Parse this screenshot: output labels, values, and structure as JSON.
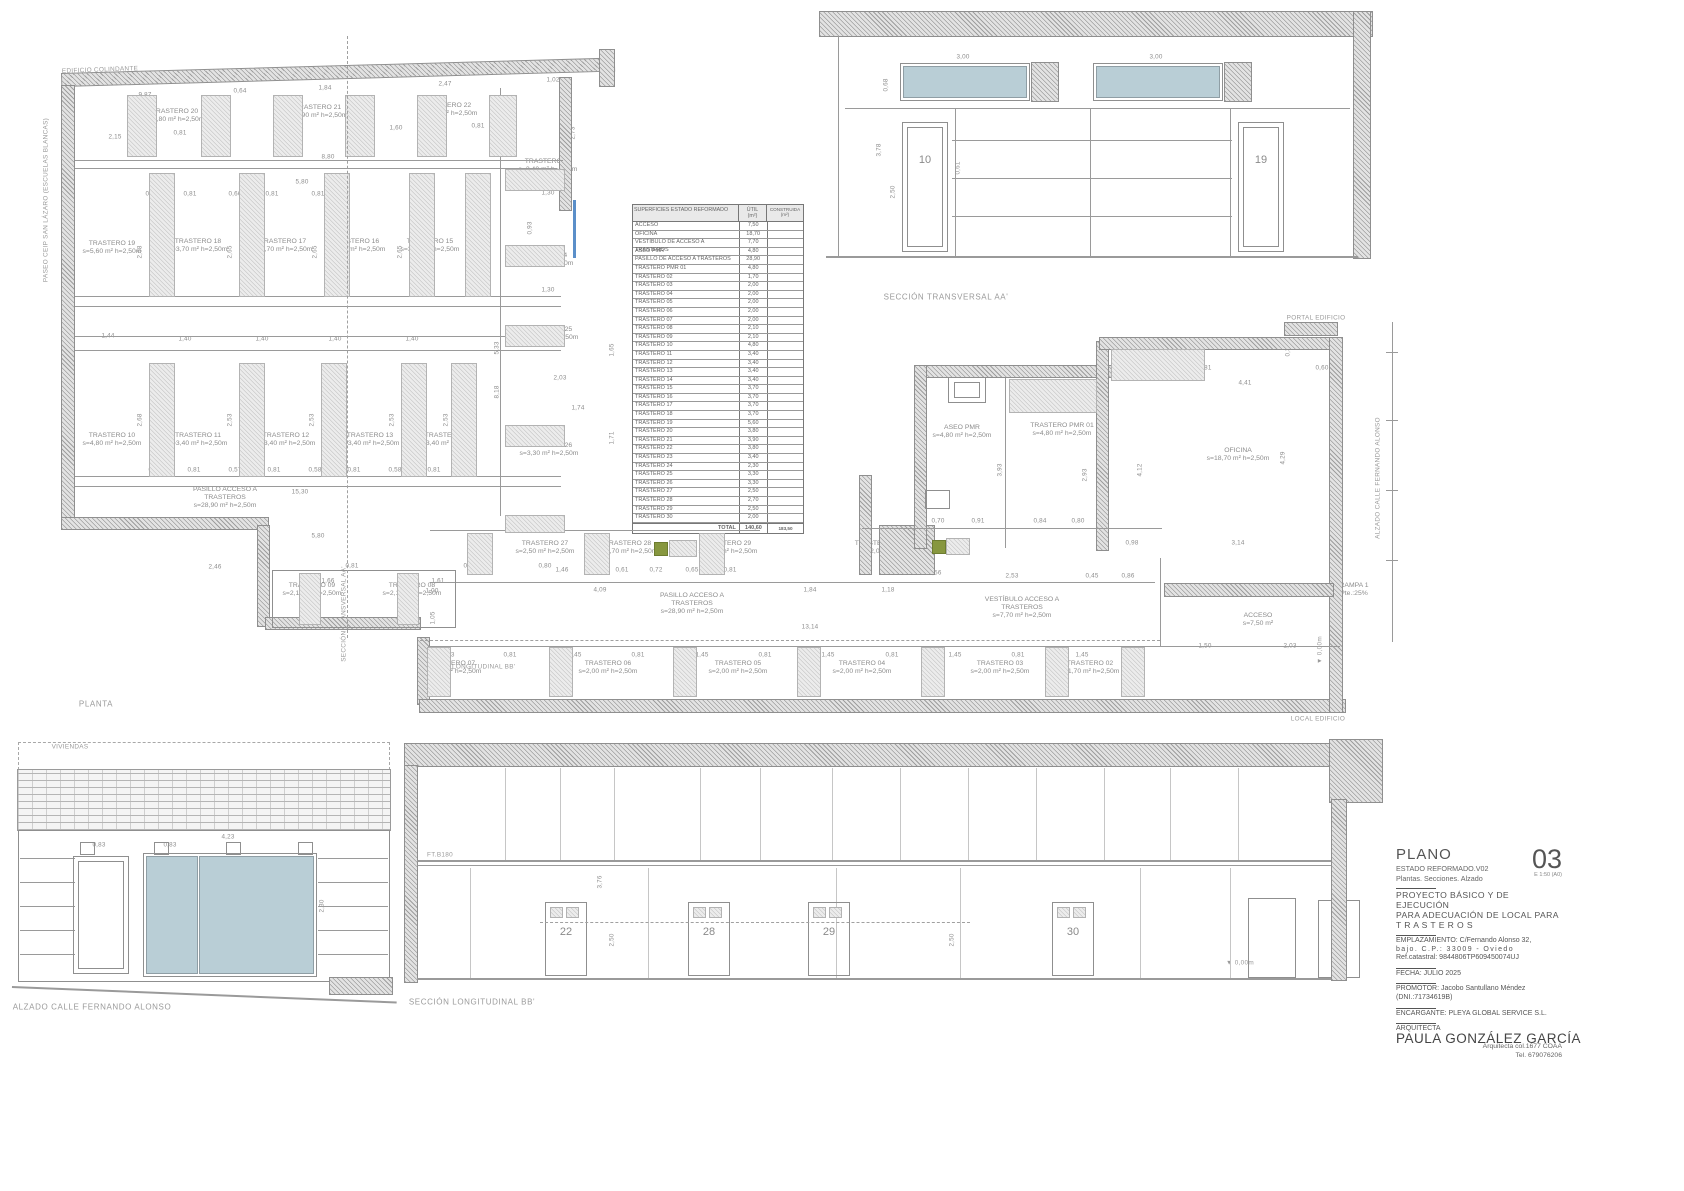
{
  "title_block": {
    "plano_label": "PLANO",
    "estado": "ESTADO REFORMADO.V02",
    "contenido": "Plantas. Secciones. Alzado",
    "sheet_number": "03",
    "scale": "E 1:50 (A0)",
    "proyecto_l1": "PROYECTO BÁSICO Y DE EJECUCIÓN",
    "proyecto_l2": "PARA ADECUACIÓN DE LOCAL PARA",
    "proyecto_l3": "T R A S T E R O S",
    "emplazamiento_l1": "EMPLAZAMIENTO: C/Fernando Alonso 32,",
    "emplazamiento_l2": "bajo. C.P.: 33009 - Oviedo",
    "emplazamiento_l3": "Ref.catastral: 9844806TP609450074UJ",
    "fecha": "FECHA: JULIO 2025",
    "promotor_l1": "PROMOTOR: Jacobo Santullano Méndez",
    "promotor_l2": "(DNI.:71734619B)",
    "encargante": "ENCARGANTE: PLEYA GLOBAL SERVICE S.L.",
    "arquitecta_label": "ARQUITECTA",
    "arquitecta_name": "PAULA GONZÁLEZ GARCÍA",
    "colegiada": "Arquitecta col.1677 COAA",
    "telefono": "Tel. 679076206"
  },
  "area_table": {
    "title": "SUPERFICIES ESTADO REFORMADO",
    "col_util": "ÚTIL",
    "col_construida": "CONSTRUIDA",
    "unit": "(m²)",
    "rows": [
      [
        "ACCESO",
        "7,50"
      ],
      [
        "OFICINA",
        "18,70"
      ],
      [
        "VESTÍBULO DE ACCESO A TRASTEROS",
        "7,70"
      ],
      [
        "ASEO PMR",
        "4,80"
      ],
      [
        "PASILLO DE ACCESO A TRASTEROS",
        "28,90"
      ],
      [
        "TRASTERO PMR 01",
        "4,80"
      ],
      [
        "TRASTERO 02",
        "1,70"
      ],
      [
        "TRASTERO 03",
        "2,00"
      ],
      [
        "TRASTERO 04",
        "2,00"
      ],
      [
        "TRASTERO 05",
        "2,00"
      ],
      [
        "TRASTERO 06",
        "2,00"
      ],
      [
        "TRASTERO 07",
        "2,00"
      ],
      [
        "TRASTERO 08",
        "2,10"
      ],
      [
        "TRASTERO 09",
        "2,10"
      ],
      [
        "TRASTERO 10",
        "4,80"
      ],
      [
        "TRASTERO 11",
        "3,40"
      ],
      [
        "TRASTERO 12",
        "3,40"
      ],
      [
        "TRASTERO 13",
        "3,40"
      ],
      [
        "TRASTERO 14",
        "3,40"
      ],
      [
        "TRASTERO 15",
        "3,70"
      ],
      [
        "TRASTERO 16",
        "3,70"
      ],
      [
        "TRASTERO 17",
        "3,70"
      ],
      [
        "TRASTERO 18",
        "3,70"
      ],
      [
        "TRASTERO 19",
        "5,60"
      ],
      [
        "TRASTERO 20",
        "3,80"
      ],
      [
        "TRASTERO 21",
        "3,90"
      ],
      [
        "TRASTERO 22",
        "3,80"
      ],
      [
        "TRASTERO 23",
        "3,40"
      ],
      [
        "TRASTERO 24",
        "2,30"
      ],
      [
        "TRASTERO 25",
        "3,30"
      ],
      [
        "TRASTERO 26",
        "3,30"
      ],
      [
        "TRASTERO 27",
        "2,50"
      ],
      [
        "TRASTERO 28",
        "2,70"
      ],
      [
        "TRASTERO 29",
        "2,50"
      ],
      [
        "TRASTERO 30",
        "2,00"
      ]
    ],
    "total_label": "TOTAL",
    "total_util": "140,60",
    "total_construida": "183,50"
  },
  "colors": {
    "glass": "#b9ced6",
    "wall_hatch": "#9e9e9e",
    "equipment_green": "#87973f",
    "section_marker_blue": "#5b8fc9"
  },
  "annotations": [
    {
      "t": "EDIFICIO COLINDANTE",
      "x": 100,
      "y": 70,
      "k": "tag",
      "r": -2
    },
    {
      "t": "PASEO CEIP SAN LÁZARO (ESCUELAS BLANCAS)",
      "x": 46,
      "y": 200,
      "k": "tag",
      "r": -90
    },
    {
      "t": "PLANTA",
      "x": 96,
      "y": 704,
      "k": "cap"
    },
    {
      "t": "SECCIÓN TRANSVERSAL AA'",
      "x": 946,
      "y": 297,
      "k": "cap"
    },
    {
      "t": "SECCIÓN LONGITUDINAL BB'",
      "x": 472,
      "y": 1002,
      "k": "cap"
    },
    {
      "t": "ALZADO CALLE FERNANDO ALONSO",
      "x": 92,
      "y": 1007,
      "k": "cap"
    },
    {
      "t": "VIVIENDAS",
      "x": 70,
      "y": 747,
      "k": "tag"
    },
    {
      "t": "FACHADA ANTERIOR",
      "x": 64,
      "y": 789,
      "k": "tag"
    },
    {
      "t": "PORTAL EDIFICIO",
      "x": 1316,
      "y": 318,
      "k": "tag"
    },
    {
      "t": "LOCAL EDIFICIO",
      "x": 1318,
      "y": 719,
      "k": "tag"
    },
    {
      "t": "ALZADO CALLE FERNANDO ALONSO",
      "x": 1378,
      "y": 478,
      "k": "tag",
      "r": -90
    },
    {
      "t": "SECCIÓN TRANSVERSAL AA'",
      "x": 344,
      "y": 614,
      "k": "tag",
      "r": -90
    },
    {
      "t": "SECCIÓN LONGITUDINAL BB'",
      "x": 467,
      "y": 667,
      "k": "tag"
    },
    {
      "t": "FT.B180",
      "x": 440,
      "y": 855,
      "k": "tag"
    },
    {
      "t": "▼ 0,00m",
      "x": 1240,
      "y": 963,
      "k": "tag"
    },
    {
      "t": "▼ 3,80m",
      "x": 310,
      "y": 786,
      "k": "tag"
    },
    {
      "t": "▼ 0,00m",
      "x": 1320,
      "y": 650,
      "k": "tag",
      "r": -90
    },
    {
      "t": "TRASTERO 20\ns=3,80 m² h=2,50m",
      "x": 175,
      "y": 116,
      "k": "room"
    },
    {
      "t": "TRASTERO 21\ns=3,90 m² h=2,50m",
      "x": 318,
      "y": 112,
      "k": "room"
    },
    {
      "t": "TRASTERO 22\ns=3,80 m² h=2,50m",
      "x": 448,
      "y": 110,
      "k": "room"
    },
    {
      "t": "TRASTERO 23\ns=3,40 m² h=2,50m",
      "x": 548,
      "y": 166,
      "k": "room"
    },
    {
      "t": "TRASTERO 19\ns=5,60 m² h=2,50m",
      "x": 112,
      "y": 248,
      "k": "room"
    },
    {
      "t": "TRASTERO 18\ns=3,70 m² h=2,50m",
      "x": 198,
      "y": 246,
      "k": "room"
    },
    {
      "t": "TRASTERO 17\ns=3,70 m² h=2,50m",
      "x": 283,
      "y": 246,
      "k": "room"
    },
    {
      "t": "TRASTERO 16\ns=3,70 m² h=2,50m",
      "x": 356,
      "y": 246,
      "k": "room"
    },
    {
      "t": "TRASTERO 15\ns=3,70 m² h=2,50m",
      "x": 430,
      "y": 246,
      "k": "room"
    },
    {
      "t": "TRASTERO 24\ns=2,30 m² h=2,50m",
      "x": 544,
      "y": 260,
      "k": "room"
    },
    {
      "t": "TRASTERO 25\ns=3,30 m² h=2,50m",
      "x": 549,
      "y": 334,
      "k": "room"
    },
    {
      "t": "TRASTERO 10\ns=4,80 m² h=2,50m",
      "x": 112,
      "y": 440,
      "k": "room"
    },
    {
      "t": "TRASTERO 11\ns=3,40 m² h=2,50m",
      "x": 198,
      "y": 440,
      "k": "room"
    },
    {
      "t": "TRASTERO 12\ns=3,40 m² h=2,50m",
      "x": 286,
      "y": 440,
      "k": "room"
    },
    {
      "t": "TRASTERO 13\ns=3,40 m² h=2,50m",
      "x": 370,
      "y": 440,
      "k": "room"
    },
    {
      "t": "TRASTERO 14\ns=3,40 m² h=2,50m",
      "x": 448,
      "y": 440,
      "k": "room"
    },
    {
      "t": "TRASTERO 26\ns=3,30 m² h=2,50m",
      "x": 549,
      "y": 450,
      "k": "room"
    },
    {
      "t": "PASILLO ACCESO A\nTRASTEROS\ns=28,90 m² h=2,50m",
      "x": 225,
      "y": 498,
      "k": "room"
    },
    {
      "t": "TRASTERO 09\ns=2,10 m² h=2,50m",
      "x": 312,
      "y": 590,
      "k": "room"
    },
    {
      "t": "TRASTERO 08\ns=2,10 m² h=2,50m",
      "x": 412,
      "y": 590,
      "k": "room"
    },
    {
      "t": "TRASTERO 27\ns=2,50 m² h=2,50m",
      "x": 545,
      "y": 548,
      "k": "room"
    },
    {
      "t": "TRASTERO 28\ns=2,70 m² h=2,50m",
      "x": 628,
      "y": 548,
      "k": "room"
    },
    {
      "t": "TRASTERO 29\ns=2,50 m² h=2,50m",
      "x": 728,
      "y": 548,
      "k": "room"
    },
    {
      "t": "TRASTERO 30\ns=2,00 m²",
      "x": 878,
      "y": 548,
      "k": "room"
    },
    {
      "t": "ASEO PMR\ns=4,80 m² h=2,50m",
      "x": 962,
      "y": 432,
      "k": "room"
    },
    {
      "t": "TRASTERO PMR 01\ns=4,80 m² h=2,50m",
      "x": 1062,
      "y": 430,
      "k": "room"
    },
    {
      "t": "OFICINA\ns=18,70 m² h=2,50m",
      "x": 1238,
      "y": 455,
      "k": "room"
    },
    {
      "t": "VESTÍBULO ACCESO A\nTRASTEROS\ns=7,70 m² h=2,50m",
      "x": 1022,
      "y": 608,
      "k": "room"
    },
    {
      "t": "PASILLO ACCESO A\nTRASTEROS\ns=28,90 m² h=2,50m",
      "x": 692,
      "y": 604,
      "k": "room"
    },
    {
      "t": "RAMPA 2\nPte.:10%",
      "x": 1258,
      "y": 592,
      "k": "room"
    },
    {
      "t": "RAMPA 1\nPte.:25%",
      "x": 1354,
      "y": 590,
      "k": "room"
    },
    {
      "t": "ACCESO\ns=7,50 m²",
      "x": 1258,
      "y": 620,
      "k": "room"
    },
    {
      "t": "TRASTERO 07\ns=2,00 m² h=2,50m",
      "x": 452,
      "y": 668,
      "k": "room"
    },
    {
      "t": "TRASTERO 06\ns=2,00 m² h=2,50m",
      "x": 608,
      "y": 668,
      "k": "room"
    },
    {
      "t": "TRASTERO 05\ns=2,00 m² h=2,50m",
      "x": 738,
      "y": 668,
      "k": "room"
    },
    {
      "t": "TRASTERO 04\ns=2,00 m² h=2,50m",
      "x": 862,
      "y": 668,
      "k": "room"
    },
    {
      "t": "TRASTERO 03\ns=2,00 m² h=2,50m",
      "x": 1000,
      "y": 668,
      "k": "room"
    },
    {
      "t": "TRASTERO 02\ns=1,70 m² h=2,50m",
      "x": 1090,
      "y": 668,
      "k": "room"
    },
    {
      "t": "10",
      "x": 925,
      "y": 160,
      "k": "door"
    },
    {
      "t": "19",
      "x": 1261,
      "y": 160,
      "k": "door"
    },
    {
      "t": "22",
      "x": 566,
      "y": 932,
      "k": "door"
    },
    {
      "t": "28",
      "x": 709,
      "y": 932,
      "k": "door"
    },
    {
      "t": "29",
      "x": 829,
      "y": 932,
      "k": "door"
    },
    {
      "t": "30",
      "x": 1073,
      "y": 932,
      "k": "door"
    },
    {
      "t": "1",
      "x": 1339,
      "y": 932,
      "k": "door"
    },
    {
      "t": "9,87",
      "x": 145,
      "y": 95,
      "k": "dim"
    },
    {
      "t": "0,64",
      "x": 240,
      "y": 91,
      "k": "dim"
    },
    {
      "t": "1,84",
      "x": 325,
      "y": 88,
      "k": "dim"
    },
    {
      "t": "2,47",
      "x": 445,
      "y": 84,
      "k": "dim"
    },
    {
      "t": "1,02",
      "x": 553,
      "y": 80,
      "k": "dim"
    },
    {
      "t": "2,15",
      "x": 115,
      "y": 137,
      "k": "dim"
    },
    {
      "t": "0,81",
      "x": 180,
      "y": 133,
      "k": "dim"
    },
    {
      "t": "1,97",
      "x": 297,
      "y": 131,
      "k": "dim"
    },
    {
      "t": "1,60",
      "x": 396,
      "y": 128,
      "k": "dim"
    },
    {
      "t": "0,81",
      "x": 478,
      "y": 126,
      "k": "dim"
    },
    {
      "t": "2,73",
      "x": 573,
      "y": 133,
      "k": "dim",
      "r": -90
    },
    {
      "t": "8,80",
      "x": 328,
      "y": 157,
      "k": "dim"
    },
    {
      "t": "5,80",
      "x": 302,
      "y": 182,
      "k": "dim"
    },
    {
      "t": "0,50",
      "x": 152,
      "y": 194,
      "k": "dim"
    },
    {
      "t": "0,81",
      "x": 190,
      "y": 194,
      "k": "dim"
    },
    {
      "t": "0,66",
      "x": 235,
      "y": 194,
      "k": "dim"
    },
    {
      "t": "0,81",
      "x": 272,
      "y": 194,
      "k": "dim"
    },
    {
      "t": "0,81",
      "x": 318,
      "y": 194,
      "k": "dim"
    },
    {
      "t": "1,30",
      "x": 548,
      "y": 193,
      "k": "dim"
    },
    {
      "t": "0,93",
      "x": 530,
      "y": 228,
      "k": "dim",
      "r": -90
    },
    {
      "t": "1,30",
      "x": 548,
      "y": 290,
      "k": "dim"
    },
    {
      "t": "2,68",
      "x": 140,
      "y": 252,
      "k": "dim",
      "r": -90
    },
    {
      "t": "2,65",
      "x": 230,
      "y": 252,
      "k": "dim",
      "r": -90
    },
    {
      "t": "2,65",
      "x": 315,
      "y": 252,
      "k": "dim",
      "r": -90
    },
    {
      "t": "2,65",
      "x": 400,
      "y": 252,
      "k": "dim",
      "r": -90
    },
    {
      "t": "1,44",
      "x": 108,
      "y": 336,
      "k": "dim"
    },
    {
      "t": "1,40",
      "x": 185,
      "y": 339,
      "k": "dim"
    },
    {
      "t": "1,40",
      "x": 262,
      "y": 339,
      "k": "dim"
    },
    {
      "t": "1,40",
      "x": 335,
      "y": 339,
      "k": "dim"
    },
    {
      "t": "1,40",
      "x": 412,
      "y": 339,
      "k": "dim"
    },
    {
      "t": "5,33",
      "x": 497,
      "y": 348,
      "k": "dim",
      "r": -90
    },
    {
      "t": "8,18",
      "x": 497,
      "y": 392,
      "k": "dim",
      "r": -90
    },
    {
      "t": "2,03",
      "x": 560,
      "y": 378,
      "k": "dim"
    },
    {
      "t": "1,74",
      "x": 578,
      "y": 408,
      "k": "dim"
    },
    {
      "t": "1,65",
      "x": 612,
      "y": 350,
      "k": "dim",
      "r": -90
    },
    {
      "t": "1,71",
      "x": 612,
      "y": 438,
      "k": "dim",
      "r": -90
    },
    {
      "t": "2,68",
      "x": 140,
      "y": 420,
      "k": "dim",
      "r": -90
    },
    {
      "t": "2,53",
      "x": 230,
      "y": 420,
      "k": "dim",
      "r": -90
    },
    {
      "t": "2,53",
      "x": 312,
      "y": 420,
      "k": "dim",
      "r": -90
    },
    {
      "t": "2,53",
      "x": 392,
      "y": 420,
      "k": "dim",
      "r": -90
    },
    {
      "t": "2,53",
      "x": 446,
      "y": 420,
      "k": "dim",
      "r": -90
    },
    {
      "t": "0,53",
      "x": 155,
      "y": 470,
      "k": "dim"
    },
    {
      "t": "0,81",
      "x": 194,
      "y": 470,
      "k": "dim"
    },
    {
      "t": "0,57",
      "x": 235,
      "y": 470,
      "k": "dim"
    },
    {
      "t": "0,81",
      "x": 274,
      "y": 470,
      "k": "dim"
    },
    {
      "t": "0,58",
      "x": 315,
      "y": 470,
      "k": "dim"
    },
    {
      "t": "0,81",
      "x": 354,
      "y": 470,
      "k": "dim"
    },
    {
      "t": "0,58",
      "x": 395,
      "y": 470,
      "k": "dim"
    },
    {
      "t": "0,81",
      "x": 434,
      "y": 470,
      "k": "dim"
    },
    {
      "t": "15,30",
      "x": 300,
      "y": 492,
      "k": "dim"
    },
    {
      "t": "5,80",
      "x": 318,
      "y": 536,
      "k": "dim"
    },
    {
      "t": "2,46",
      "x": 215,
      "y": 567,
      "k": "dim"
    },
    {
      "t": "0,81",
      "x": 352,
      "y": 566,
      "k": "dim"
    },
    {
      "t": "0,81",
      "x": 470,
      "y": 566,
      "k": "dim"
    },
    {
      "t": "0,80",
      "x": 545,
      "y": 566,
      "k": "dim"
    },
    {
      "t": "1,66",
      "x": 328,
      "y": 581,
      "k": "dim"
    },
    {
      "t": "1,61",
      "x": 438,
      "y": 581,
      "k": "dim"
    },
    {
      "t": "1,46",
      "x": 562,
      "y": 570,
      "k": "dim"
    },
    {
      "t": "0,61",
      "x": 622,
      "y": 570,
      "k": "dim"
    },
    {
      "t": "0,72",
      "x": 656,
      "y": 570,
      "k": "dim"
    },
    {
      "t": "0,65",
      "x": 692,
      "y": 570,
      "k": "dim"
    },
    {
      "t": "0,81",
      "x": 730,
      "y": 570,
      "k": "dim"
    },
    {
      "t": "1,00",
      "x": 432,
      "y": 591,
      "k": "dim"
    },
    {
      "t": "4,09",
      "x": 600,
      "y": 590,
      "k": "dim"
    },
    {
      "t": "1,84",
      "x": 810,
      "y": 590,
      "k": "dim"
    },
    {
      "t": "1,18",
      "x": 888,
      "y": 590,
      "k": "dim"
    },
    {
      "t": "13,14",
      "x": 810,
      "y": 627,
      "k": "dim"
    },
    {
      "t": "1,05",
      "x": 433,
      "y": 618,
      "k": "dim",
      "r": -90
    },
    {
      "t": "3,81",
      "x": 1205,
      "y": 368,
      "k": "dim"
    },
    {
      "t": "4,41",
      "x": 1245,
      "y": 383,
      "k": "dim"
    },
    {
      "t": "1,64",
      "x": 1048,
      "y": 390,
      "k": "dim"
    },
    {
      "t": "3,93",
      "x": 1000,
      "y": 470,
      "k": "dim",
      "r": -90
    },
    {
      "t": "2,93",
      "x": 1085,
      "y": 475,
      "k": "dim",
      "r": -90
    },
    {
      "t": "4,12",
      "x": 1140,
      "y": 470,
      "k": "dim",
      "r": -90
    },
    {
      "t": "0,70",
      "x": 938,
      "y": 521,
      "k": "dim"
    },
    {
      "t": "0,91",
      "x": 978,
      "y": 521,
      "k": "dim"
    },
    {
      "t": "0,84",
      "x": 1040,
      "y": 521,
      "k": "dim"
    },
    {
      "t": "0,80",
      "x": 1078,
      "y": 521,
      "k": "dim"
    },
    {
      "t": "0,98",
      "x": 1132,
      "y": 543,
      "k": "dim"
    },
    {
      "t": "3,14",
      "x": 1238,
      "y": 543,
      "k": "dim"
    },
    {
      "t": "2,53",
      "x": 1012,
      "y": 576,
      "k": "dim"
    },
    {
      "t": "0,45",
      "x": 1092,
      "y": 576,
      "k": "dim"
    },
    {
      "t": "0,86",
      "x": 1128,
      "y": 576,
      "k": "dim"
    },
    {
      "t": "4,43",
      "x": 1190,
      "y": 590,
      "k": "dim"
    },
    {
      "t": "0,56",
      "x": 935,
      "y": 573,
      "k": "dim"
    },
    {
      "t": "4,29",
      "x": 1283,
      "y": 458,
      "k": "dim",
      "r": -90
    },
    {
      "t": "0,37",
      "x": 1288,
      "y": 350,
      "k": "dim",
      "r": -90
    },
    {
      "t": "0,60",
      "x": 1322,
      "y": 368,
      "k": "dim"
    },
    {
      "t": "1,50",
      "x": 1205,
      "y": 646,
      "k": "dim"
    },
    {
      "t": "2,03",
      "x": 1290,
      "y": 646,
      "k": "dim"
    },
    {
      "t": "1,43",
      "x": 448,
      "y": 655,
      "k": "dim"
    },
    {
      "t": "0,81",
      "x": 510,
      "y": 655,
      "k": "dim"
    },
    {
      "t": "1,45",
      "x": 575,
      "y": 655,
      "k": "dim"
    },
    {
      "t": "0,81",
      "x": 638,
      "y": 655,
      "k": "dim"
    },
    {
      "t": "1,45",
      "x": 702,
      "y": 655,
      "k": "dim"
    },
    {
      "t": "0,81",
      "x": 765,
      "y": 655,
      "k": "dim"
    },
    {
      "t": "1,45",
      "x": 828,
      "y": 655,
      "k": "dim"
    },
    {
      "t": "0,81",
      "x": 892,
      "y": 655,
      "k": "dim"
    },
    {
      "t": "1,45",
      "x": 955,
      "y": 655,
      "k": "dim"
    },
    {
      "t": "0,81",
      "x": 1018,
      "y": 655,
      "k": "dim"
    },
    {
      "t": "1,45",
      "x": 1082,
      "y": 655,
      "k": "dim"
    },
    {
      "t": "0,88",
      "x": 433,
      "y": 667,
      "k": "dim",
      "r": -90
    },
    {
      "t": "3,00",
      "x": 963,
      "y": 57,
      "k": "dim"
    },
    {
      "t": "3,00",
      "x": 1156,
      "y": 57,
      "k": "dim"
    },
    {
      "t": "0,68",
      "x": 886,
      "y": 85,
      "k": "dim",
      "r": -90
    },
    {
      "t": "3,78",
      "x": 879,
      "y": 150,
      "k": "dim",
      "r": -90
    },
    {
      "t": "2,50",
      "x": 893,
      "y": 192,
      "k": "dim",
      "r": -90
    },
    {
      "t": "0,61",
      "x": 958,
      "y": 168,
      "k": "dim",
      "r": -90
    },
    {
      "t": "0,64",
      "x": 1232,
      "y": 90,
      "k": "dim",
      "r": -90
    },
    {
      "t": "0,83",
      "x": 99,
      "y": 845,
      "k": "dim"
    },
    {
      "t": "0,83",
      "x": 170,
      "y": 845,
      "k": "dim"
    },
    {
      "t": "4,23",
      "x": 228,
      "y": 837,
      "k": "dim"
    },
    {
      "t": "2,30",
      "x": 322,
      "y": 906,
      "k": "dim",
      "r": -90
    },
    {
      "t": "3,76",
      "x": 600,
      "y": 882,
      "k": "dim",
      "r": -90
    },
    {
      "t": "2,50",
      "x": 612,
      "y": 940,
      "k": "dim",
      "r": -90
    },
    {
      "t": "2,50",
      "x": 952,
      "y": 940,
      "k": "dim",
      "r": -90
    }
  ]
}
